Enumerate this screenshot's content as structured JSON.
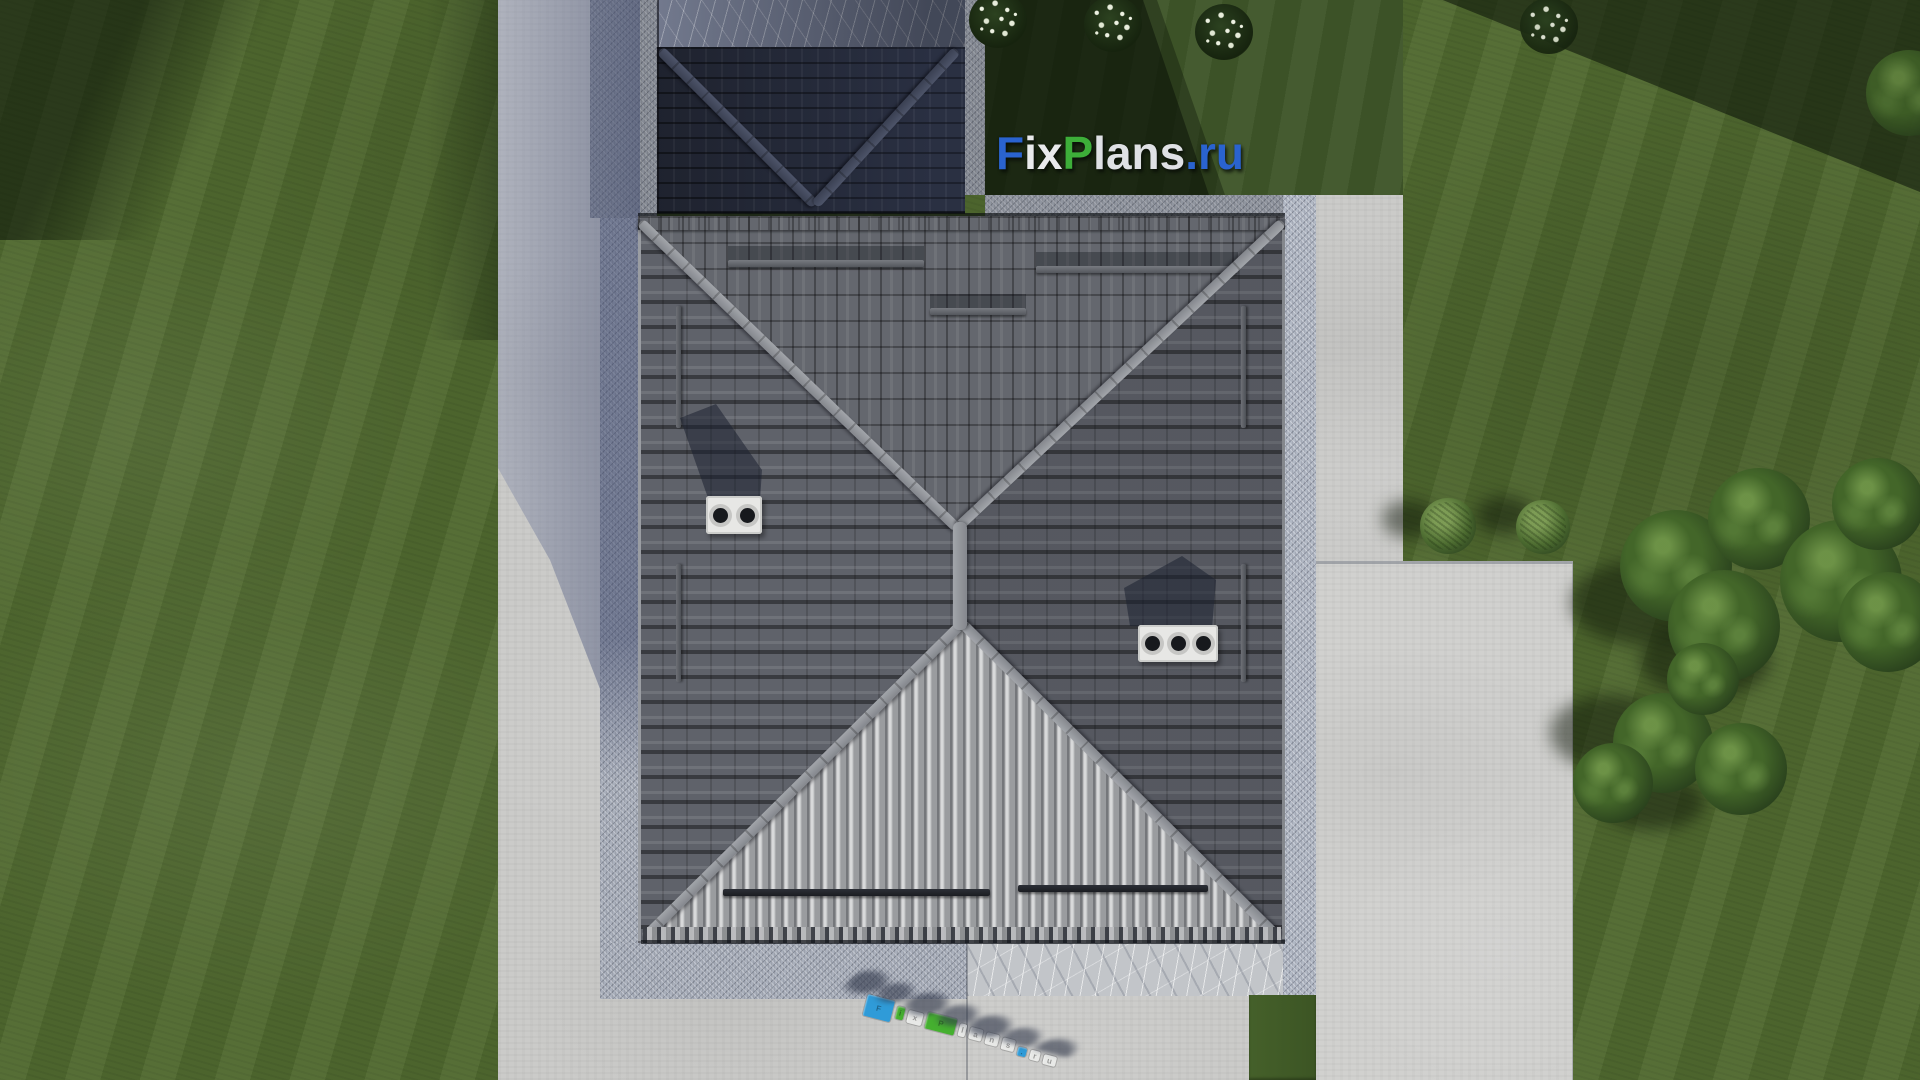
{
  "scene": {
    "description": "Aerial top-down 3D architectural render of a house plot with grey hip roof, paved yard, lawn, shrubs and trees",
    "watermark_logo": {
      "full_text": "FixPlans.ru",
      "parts": [
        {
          "text": "F",
          "color": "#2a63cf"
        },
        {
          "text": "ix",
          "color": "#e9eaec"
        },
        {
          "text": "P",
          "color": "#3dae39"
        },
        {
          "text": "lans",
          "color": "#dfe1e4"
        },
        {
          "text": ".ru",
          "color": "#2a63cf"
        }
      ]
    },
    "ground_logo_3d": {
      "text": "FixPlans.ru",
      "letters": [
        {
          "char": "F",
          "color": "#2f9bd8"
        },
        {
          "char": "i",
          "color": "#45b02f"
        },
        {
          "char": "x",
          "color": "#e8e9e7"
        },
        {
          "char": "P",
          "color": "#45b02f"
        },
        {
          "char": "l",
          "color": "#e8e9e7"
        },
        {
          "char": "a",
          "color": "#e8e9e7"
        },
        {
          "char": "n",
          "color": "#e8e9e7"
        },
        {
          "char": "s",
          "color": "#e8e9e7"
        },
        {
          "char": ".",
          "color": "#2f9bd8"
        },
        {
          "char": "r",
          "color": "#e8e9e7"
        },
        {
          "char": "u",
          "color": "#e8e9e7"
        }
      ]
    },
    "roof": {
      "type": "hip-roof",
      "chimneys": [
        {
          "side": "west",
          "vents": 2
        },
        {
          "side": "east",
          "vents": 3
        }
      ],
      "snow_guard_rails": 9
    },
    "landscape": {
      "flower_bushes": 4,
      "round_shrubs": 2,
      "tree_clusters": 3
    },
    "palette": {
      "grass_sunlit": "#50692f",
      "grass_shadow": "#16230e",
      "pavement_sunlit": "#cbcbc9",
      "pavement_shadow": "#8b93a8",
      "roof_tile_grey": "#5f626a",
      "roof_tile_bright": "#adafb1",
      "roof_navy_shadow": "#262b3a",
      "brand_blue": "#2a63cf",
      "brand_green": "#3dae39"
    }
  }
}
